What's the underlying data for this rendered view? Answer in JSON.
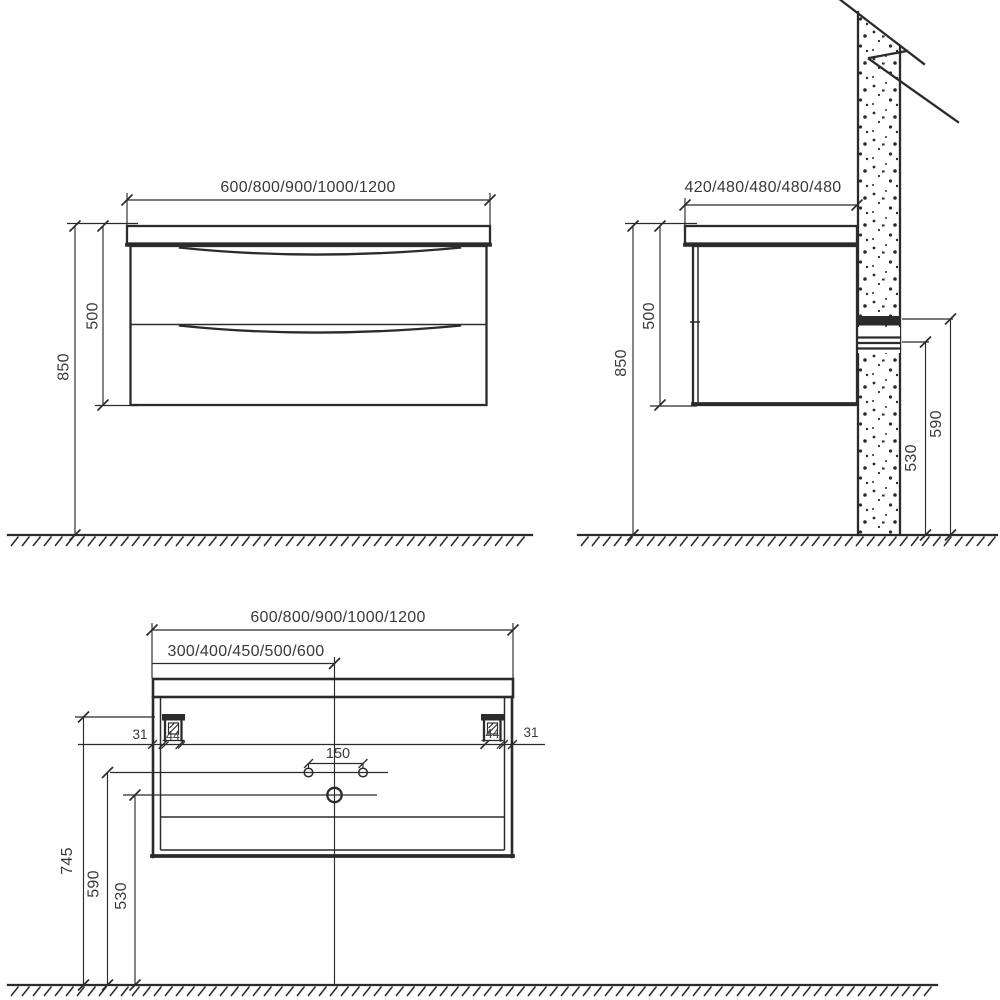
{
  "front_view": {
    "width_options": "600/800/900/1000/1200",
    "total_height": "850",
    "cabinet_height": "500"
  },
  "side_view": {
    "depth_options": "420/480/480/480/480",
    "total_height": "850",
    "cabinet_height": "500",
    "drain_outlet_height": "590",
    "supply_outlet_height": "530"
  },
  "rear_view": {
    "width_options": "600/800/900/1000/1200",
    "center_offset_options": "300/400/450/500/600",
    "bracket_edge_offset_left": "31",
    "bracket_edge_offset_right": "31",
    "bracket_width_left": "44",
    "bracket_width_right": "44",
    "faucet_hole_spacing": "150",
    "bracket_height": "745",
    "hole_line_height": "590",
    "drain_line_height": "530"
  }
}
